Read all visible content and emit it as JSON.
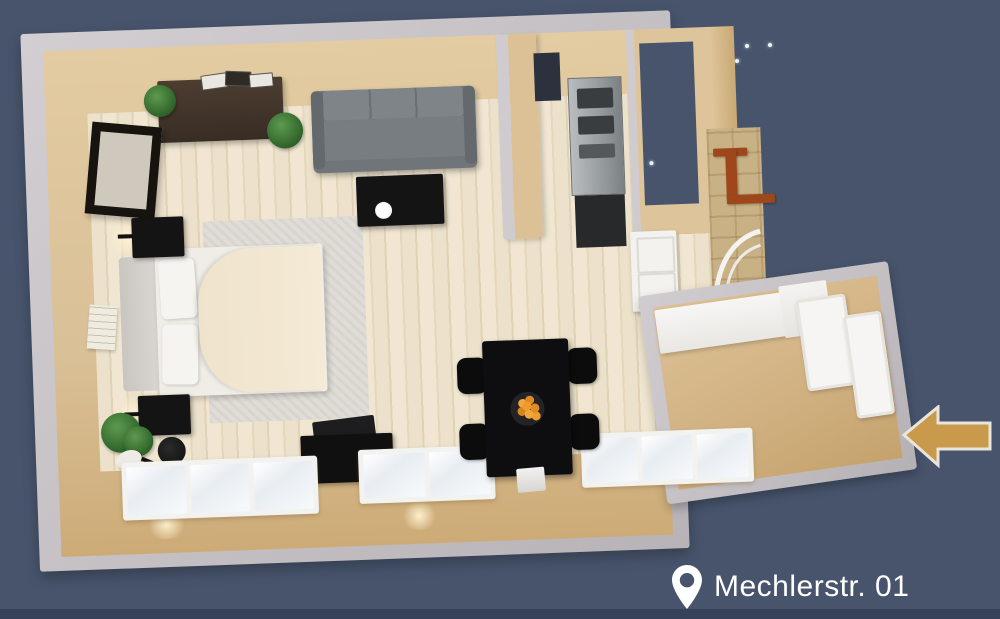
{
  "scene": {
    "description": "3D top-down rendered floor plan of a studio apartment on slate blue background",
    "background_color": "#47546c",
    "star_dots_count": 4
  },
  "address_label": {
    "text": "Mechlerstr. 01",
    "icon": "location-pin",
    "text_color": "#ffffff"
  },
  "entrance_arrow": {
    "direction": "left",
    "fill": "#c99a4b",
    "outline": "#e9e5da"
  },
  "floor_plan": {
    "view": "top-down-3d-render",
    "rotation_deg": -2.1,
    "colors": {
      "wall_top": "#c3bfc3",
      "wall_face_tan": "#d9c096",
      "floor_wood": "#ece1cb",
      "floor_entry_tan": "#d0b080",
      "brick": "#c8b184",
      "stair_rail_red": "#a0461c",
      "sofa_gray": "#70757a",
      "furniture_black": "#101011",
      "bed_duvet": "#f2e8d3"
    },
    "rooms": [
      "living-bedroom-studio",
      "kitchen",
      "corridor",
      "entry-hall",
      "exterior-stairwell"
    ],
    "furniture": [
      "dresser-with-books-and-plants",
      "wall-mirror",
      "three-seat-sofa",
      "coffee-table-with-plate",
      "double-bed-with-pillows-and-duvet",
      "area-rug",
      "nightstand-top-with-wall-lamp",
      "nightstand-bottom-with-wall-lamp",
      "wall-poster",
      "potted-plant",
      "floor-fan",
      "tv-sideboard-with-tv",
      "dining-table",
      "dining-chairs-x4",
      "fruit-bowl-with-oranges",
      "laptop-on-table",
      "kitchen-appliances-stainless",
      "kitchen-dark-counter",
      "closet-door-panels",
      "entry-white-counter",
      "entry-wall-panels",
      "south-windows-x3",
      "stair-handrail-red",
      "curved-white-railing"
    ]
  }
}
